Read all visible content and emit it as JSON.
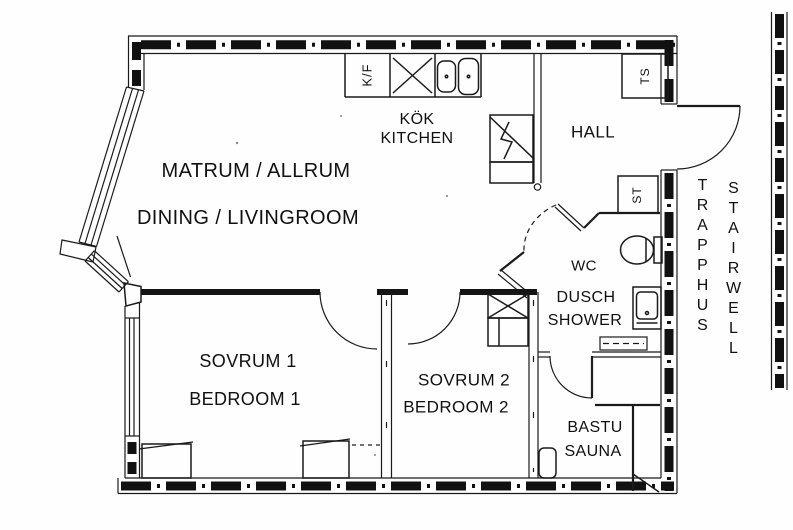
{
  "floorplan": {
    "title": "apartment-floor-plan",
    "labels": {
      "matrum_allrum": "MATRUM / ALLRUM",
      "dining_livingroom": "DINING / LIVINGROOM",
      "kok": "KÖK",
      "kitchen": "KITCHEN",
      "hall": "HALL",
      "wc": "WC",
      "dusch": "DUSCH",
      "shower": "SHOWER",
      "sovrum1": "SOVRUM 1",
      "bedroom1": "BEDROOM 1",
      "sovrum2": "SOVRUM 2",
      "bedroom2": "BEDROOM 2",
      "bastu": "BASTU",
      "sauna": "SAUNA",
      "trapphus": "TRAPPHUS",
      "stairwell": "STAIRWELL",
      "fridge_freezer": "K/F",
      "drying_cabinet": "TS",
      "cleaning_closet": "ST"
    },
    "colors": {
      "ink": "#1a1a1a",
      "paper": "#fefefe"
    }
  }
}
